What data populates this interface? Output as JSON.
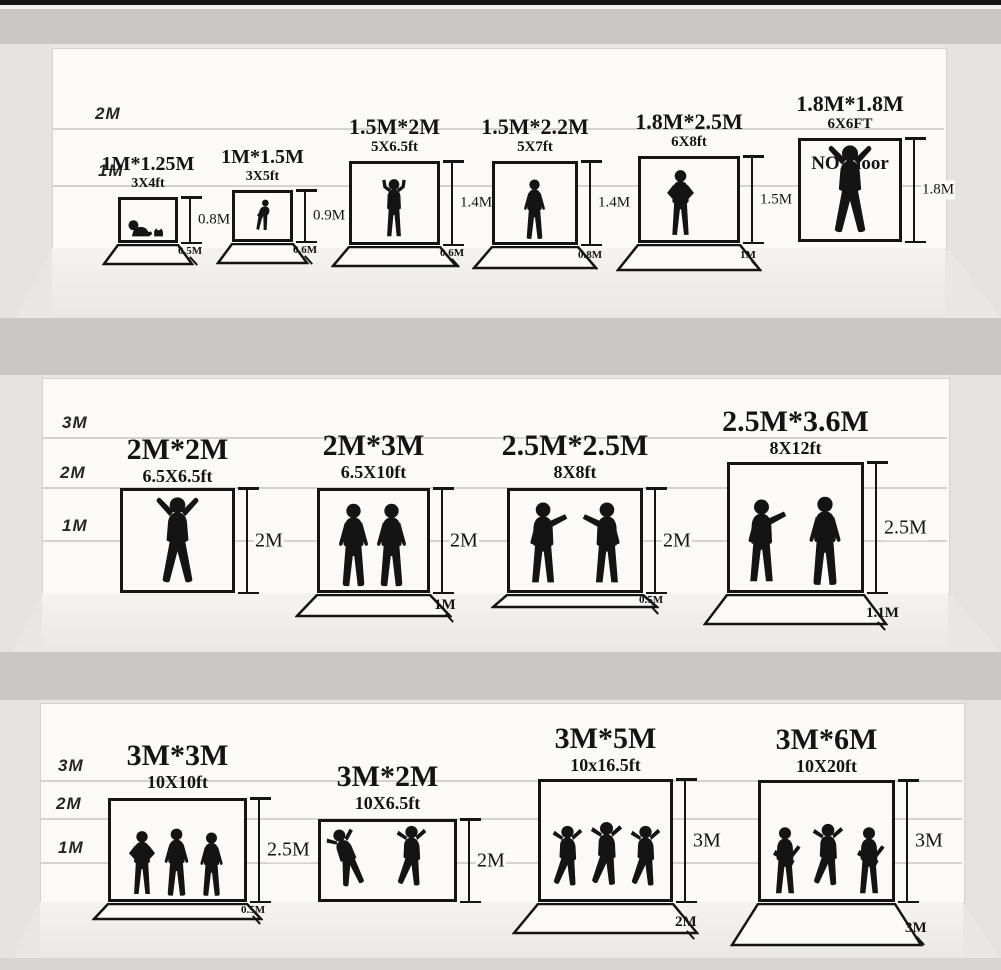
{
  "rows": [
    {
      "scale": [
        "2M",
        "1M"
      ],
      "backdrops": [
        {
          "size": "1M*1.25M",
          "ft": "3X4ft",
          "height": "0.8M",
          "floor": "0.5M",
          "figures": "baby-and-cat-silhouette"
        },
        {
          "size": "1M*1.5M",
          "ft": "3X5ft",
          "height": "0.9M",
          "floor": "0.6M",
          "figures": "toddler-silhouette"
        },
        {
          "size": "1.5M*2M",
          "ft": "5X6.5ft",
          "height": "1.4M",
          "floor": "0.6M",
          "figures": "child-cheering-silhouette"
        },
        {
          "size": "1.5M*2.2M",
          "ft": "5X7ft",
          "height": "1.4M",
          "floor": "0.8M",
          "figures": "child-standing-silhouette"
        },
        {
          "size": "1.8M*2.5M",
          "ft": "6X8ft",
          "height": "1.5M",
          "floor": "1M",
          "figures": "teen-hands-on-hips-silhouette"
        },
        {
          "size": "1.8M*1.8M",
          "ft": "6X6FT",
          "height": "1.8M",
          "note": "NO Floor",
          "figures": "man-arms-raised-silhouette"
        }
      ]
    },
    {
      "scale": [
        "3M",
        "2M",
        "1M"
      ],
      "backdrops": [
        {
          "size": "2M*2M",
          "ft": "6.5X6.5ft",
          "height": "2M",
          "figures": "man-arms-raised-silhouette"
        },
        {
          "size": "2M*3M",
          "ft": "6.5X10ft",
          "height": "2M",
          "floor": "1M",
          "figures": "two-men-standing-silhouette"
        },
        {
          "size": "2.5M*2.5M",
          "ft": "8X8ft",
          "height": "2M",
          "floor": "0.5M",
          "figures": "two-men-talking-silhouette"
        },
        {
          "size": "2.5M*3.6M",
          "ft": "8X12ft",
          "height": "2.5M",
          "floor": "1.1M",
          "figures": "two-men-pointing-silhouette"
        }
      ]
    },
    {
      "scale": [
        "3M",
        "2M",
        "1M"
      ],
      "backdrops": [
        {
          "size": "3M*3M",
          "ft": "10X10ft",
          "height": "2.5M",
          "floor": "0.5M",
          "figures": "three-people-silhouette"
        },
        {
          "size": "3M*2M",
          "ft": "10X6.5ft",
          "height": "2M",
          "figures": "two-dancers-silhouette"
        },
        {
          "size": "3M*5M",
          "ft": "10x16.5ft",
          "height": "3M",
          "floor": "2M",
          "figures": "three-dancers-silhouette"
        },
        {
          "size": "3M*6M",
          "ft": "10X20ft",
          "height": "3M",
          "floor": "3M",
          "figures": "three-musicians-silhouette"
        }
      ]
    }
  ],
  "colors": {
    "ink": "#141414",
    "wall": "#fbfaf8",
    "shelf_band": "#c9c8c6",
    "top_bar": "#161616"
  }
}
